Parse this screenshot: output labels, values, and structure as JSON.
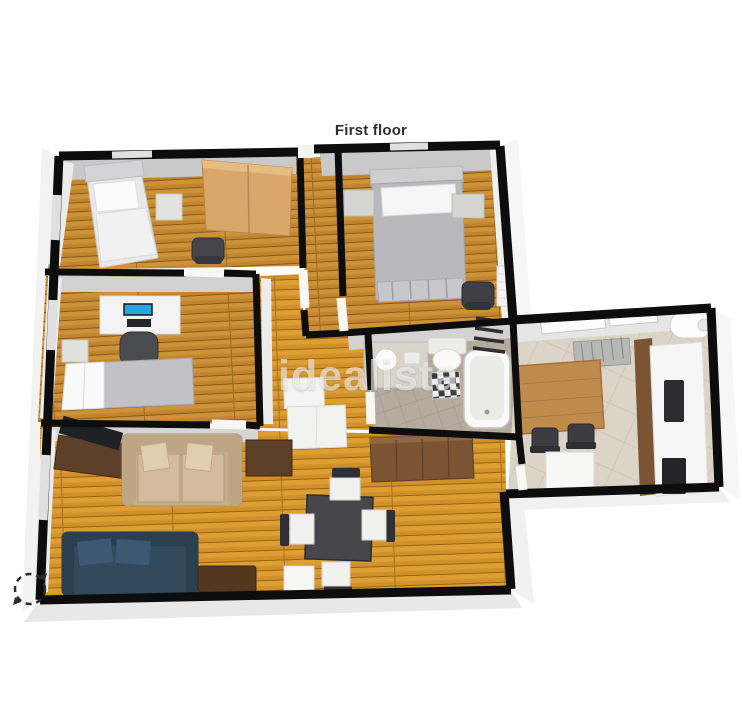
{
  "page": {
    "title": "First floor",
    "watermark": "idealista",
    "background": "#ffffff"
  },
  "palette": {
    "wall_cut": "#0d0d0d",
    "wall_face": "#ececec",
    "wood_floor_living": "#cf8d26",
    "wood_floor_bedroom": "#c28430",
    "bath_tile": "#b5ac9f",
    "kitchen_tile": "#dcd5c7",
    "wardrobe_wood": "#d9a76a",
    "sofa_beige": "#c7ae8c",
    "sofa_teal": "#31495a",
    "furniture_dark": "#3c3c42",
    "sideboard_brown": "#6e4b2d",
    "monitor_blue": "#28a5de"
  },
  "floorplan": {
    "label": "First floor",
    "view": "3d-isometric",
    "rooms": [
      {
        "name": "bedroom-1",
        "floor": "wood",
        "furniture": [
          "single bed",
          "nightstand",
          "wardrobe",
          "desk chair"
        ]
      },
      {
        "name": "bedroom-2-master",
        "floor": "wood",
        "furniture": [
          "double bed",
          "nightstand left",
          "nightstand right",
          "chair",
          "radiator"
        ]
      },
      {
        "name": "bedroom-3-office",
        "floor": "wood",
        "furniture": [
          "desk",
          "monitor",
          "keyboard",
          "office chair",
          "single bed",
          "nightstand"
        ]
      },
      {
        "name": "hallway",
        "floor": "wood",
        "furniture": [
          "closet",
          "cabinet"
        ]
      },
      {
        "name": "bathroom",
        "floor": "tile",
        "furniture": [
          "washbasin vanity",
          "toilet",
          "checkered bath mat",
          "bathtub",
          "towel ladder"
        ]
      },
      {
        "name": "kitchen",
        "floor": "tile",
        "furniture": [
          "dining table",
          "two chairs",
          "drying rack",
          "counter",
          "oven",
          "cooktop",
          "water heater",
          "white cabinet"
        ]
      },
      {
        "name": "living-dining-room",
        "floor": "wood",
        "furniture": [
          "tv sideboard",
          "beige sofa",
          "two throw pillows",
          "wood cabinet",
          "long sideboard",
          "teal sofa",
          "coffee table",
          "square dining table",
          "four chairs",
          "white side table"
        ]
      }
    ],
    "controls": {
      "rotate_icon": "rotate-arrows"
    }
  }
}
